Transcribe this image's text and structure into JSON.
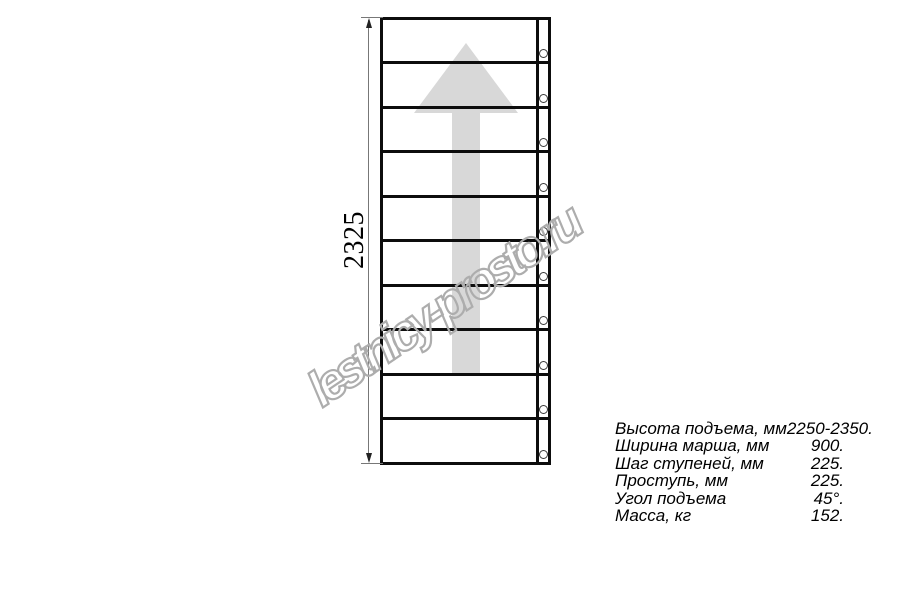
{
  "watermark": {
    "text": "lestnicy-prosto.ru",
    "outline_color": "#adadad"
  },
  "drawing": {
    "dimension_label": "2325",
    "treads": 10,
    "arrow_icon": "up-arrow",
    "colors": {
      "line": "#0d0d0d",
      "arrow_fill": "#d8d8d8",
      "dimension_line": "#777777"
    }
  },
  "specs": {
    "rows": [
      {
        "label": "Высота подъема, мм",
        "value": "2250-2350."
      },
      {
        "label": "Ширина марша, мм",
        "value": "900."
      },
      {
        "label": "Шаг ступеней, мм",
        "value": "225."
      },
      {
        "label": "Проступь, мм",
        "value": "225."
      },
      {
        "label": "Угол подъема",
        "value": "45°."
      },
      {
        "label": "Масса, кг",
        "value": "152."
      }
    ]
  }
}
